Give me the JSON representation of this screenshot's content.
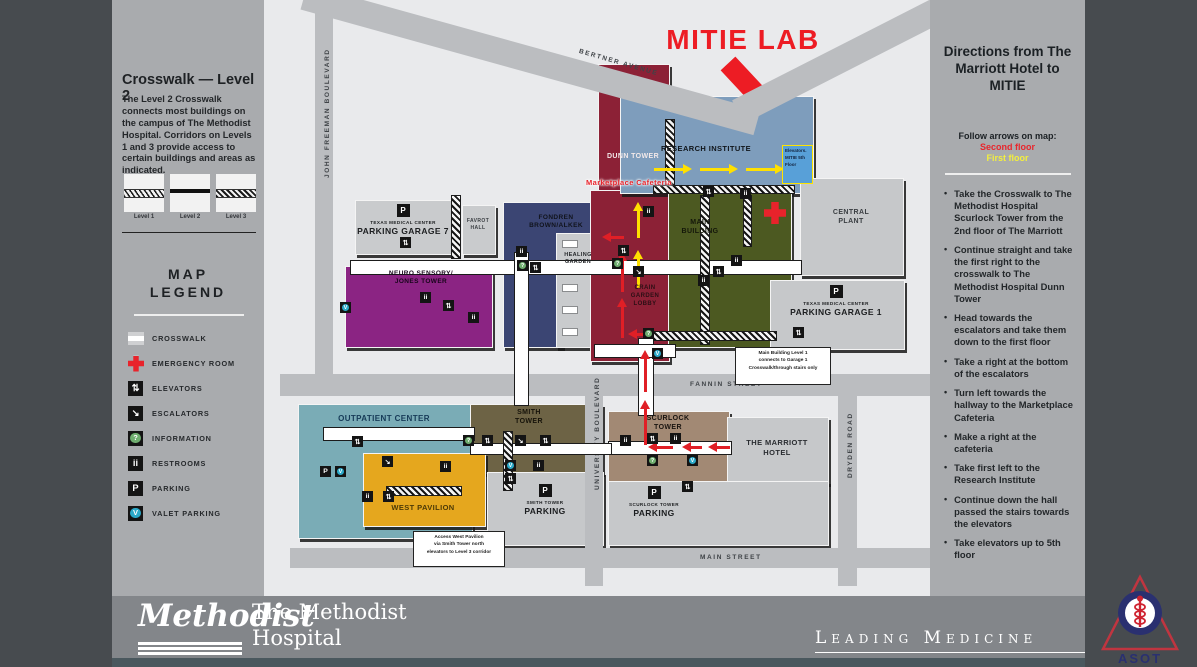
{
  "left_panel": {
    "crosswalk_title": "Crosswalk — Level 2",
    "crosswalk_text": "The Level 2 Crosswalk connects most buildings on the campus of The Methodist Hospital. Corridors on Levels 1 and 3 provide access to certain buildings and areas as indicated.",
    "levels": [
      "Level 1",
      "Level 2",
      "Level 3"
    ],
    "legend_title_1": "MAP",
    "legend_title_2": "LEGEND",
    "legend_items": [
      {
        "icon": "crosswalk-swatch",
        "label": "CROSSWALK"
      },
      {
        "icon": "emergency-cross",
        "label": "EMERGENCY ROOM"
      },
      {
        "icon": "elevators",
        "label": "ELEVATORS"
      },
      {
        "icon": "escalators",
        "label": "ESCALATORS"
      },
      {
        "icon": "information",
        "label": "INFORMATION"
      },
      {
        "icon": "restrooms",
        "label": "RESTROOMS"
      },
      {
        "icon": "parking",
        "label": "PARKING"
      },
      {
        "icon": "valet",
        "label": "VALET PARKING"
      }
    ]
  },
  "map": {
    "title": "MITIE LAB",
    "mitie_box_lines": [
      "Elevators.",
      "MITIE 5th",
      "Floor"
    ],
    "colors": {
      "second_floor_arrow": "#e01f26",
      "first_floor_arrow": "#ffe000",
      "mitie_red": "#ed1c24",
      "emergency_red": "#e8232b",
      "information_green": "#6fae6f",
      "valet_teal": "#2ba9c9"
    },
    "icon_glyphs": {
      "ev": "⇅",
      "es": "↘",
      "rr": "ii",
      "in": "?",
      "va": "V",
      "pk": "P"
    },
    "streets": [
      {
        "id": "bertner",
        "name": "BERTNER AVENUE"
      },
      {
        "id": "johnfreeman",
        "name": "JOHN FREEMAN BOULEVARD"
      },
      {
        "id": "fannin",
        "name": "FANNIN STREET"
      },
      {
        "id": "university",
        "name": "UNIVERSITY BOULEVARD"
      },
      {
        "id": "dryden",
        "name": "DRYDEN ROAD"
      },
      {
        "id": "mainst",
        "name": "MAIN STREET"
      }
    ],
    "buildings": [
      {
        "id": "garage7",
        "lines": [
          "TEXAS MEDICAL CENTER",
          "PARKING GARAGE 7"
        ],
        "color": "#c9cbcd",
        "text_color": "#1c1e20",
        "cluster": true
      },
      {
        "id": "favrot",
        "lines": [
          "FAVROT",
          "HALL"
        ],
        "color": "#c9cbcd",
        "text_color": "#3a3e42"
      },
      {
        "id": "fondren",
        "lines": [
          "FONDREN",
          "BROWN/ALKEK"
        ],
        "color": "#3b4573",
        "text_color": "#10131c"
      },
      {
        "id": "healing",
        "lines": [
          "HEALING",
          "GARDEN"
        ],
        "color": "#c9cbcd",
        "text_color": "#26292c"
      },
      {
        "id": "dunn",
        "lines": [
          "DUNN TOWER"
        ],
        "color": "#8c2136",
        "text_color": "#f2e9e9"
      },
      {
        "id": "research",
        "lines": [
          "RESEARCH INSTITUTE"
        ],
        "color": "#7e9dbc",
        "text_color": "#10151a"
      },
      {
        "id": "main",
        "lines": [
          "MAIN",
          "BUILDING"
        ],
        "color": "#4c5921",
        "text_color": "#14170a"
      },
      {
        "id": "central",
        "lines": [
          "CENTRAL",
          "PLANT"
        ],
        "color": "#c6c8ca",
        "text_color": "#3a3e42"
      },
      {
        "id": "garage1",
        "lines": [
          "TEXAS MEDICAL CENTER",
          "PARKING GARAGE 1"
        ],
        "color": "#c6c8ca",
        "text_color": "#1c1e20",
        "cluster": true
      },
      {
        "id": "crain",
        "lines": [
          "CRAIN",
          "GARDEN",
          "LOBBY"
        ],
        "color": "#8c2136",
        "text_color": "#2b0f15"
      },
      {
        "id": "neuro",
        "lines": [
          "NEURO SENSORY/",
          "JONES TOWER"
        ],
        "color": "#8b2483",
        "text_color": "#17051a"
      },
      {
        "id": "outpatient",
        "lines": [
          "OUTPATIENT CENTER"
        ],
        "color": "#7aacb6",
        "text_color": "#163a57"
      },
      {
        "id": "smith",
        "lines": [
          "SMITH",
          "TOWER"
        ],
        "color": "#6d6345",
        "text_color": "#16130a"
      },
      {
        "id": "west",
        "lines": [
          "WEST PAVILION"
        ],
        "color": "#e5a71e",
        "text_color": "#4c3a07"
      },
      {
        "id": "smithpark",
        "lines": [
          "SMITH TOWER",
          "PARKING"
        ],
        "color": "#c6c8ca",
        "text_color": "#1c1e20",
        "cluster": true
      },
      {
        "id": "scurlock",
        "lines": [
          "SCURLOCK",
          "TOWER"
        ],
        "color": "#a28974",
        "text_color": "#191410"
      },
      {
        "id": "marriott",
        "lines": [
          "THE MARRIOTT",
          "HOTEL"
        ],
        "color": "#c6c8ca",
        "text_color": "#2a2d31"
      },
      {
        "id": "scurlockpark",
        "lines": [
          "SCURLOCK TOWER",
          "PARKING"
        ],
        "color": "#c6c8ca",
        "text_color": "#1c1e20",
        "cluster": true
      }
    ],
    "extra_labels": [
      {
        "id": "marketplace",
        "text": "Marketplace Cafeteria",
        "color": "#e8232b"
      }
    ],
    "notes": [
      {
        "id": "note1",
        "lines": [
          "Main Building Level 1",
          "connects to Garage 1",
          "Crosswalk/through stairs only"
        ]
      },
      {
        "id": "note2",
        "lines": [
          "Access West Pavilion",
          "via Smith Tower north",
          "elevators to Level 3 corridor"
        ]
      }
    ]
  },
  "right_panel": {
    "title": "Directions from The Marriott Hotel to MITIE",
    "follow_label": "Follow arrows on map:",
    "second_floor": "Second floor",
    "first_floor": "First floor",
    "second_floor_color": "#e8262d",
    "first_floor_color": "#f3ef3d",
    "steps": [
      "Take the Crosswalk to The Methodist Hospital Scurlock Tower from the 2nd floor of The Marriott",
      "Continue straight and take the first right to the crosswalk to The Methodist Hospital Dunn Tower",
      "Head towards the escalators and take them down to the first floor",
      "Take a right at the bottom of the escalators",
      "Turn left towards the hallway to the Marketplace Cafeteria",
      "Make a right at the cafeteria",
      "Take first left to the Research Institute",
      "Continue down the hall passed the stairs towards the elevators",
      "Take elevators up to 5th floor"
    ]
  },
  "footer": {
    "brand": "Methodist",
    "name_line1": "The Methodist",
    "name_line2": "Hospital",
    "tagline": "Leading Medicine",
    "asot": "ASOT"
  }
}
